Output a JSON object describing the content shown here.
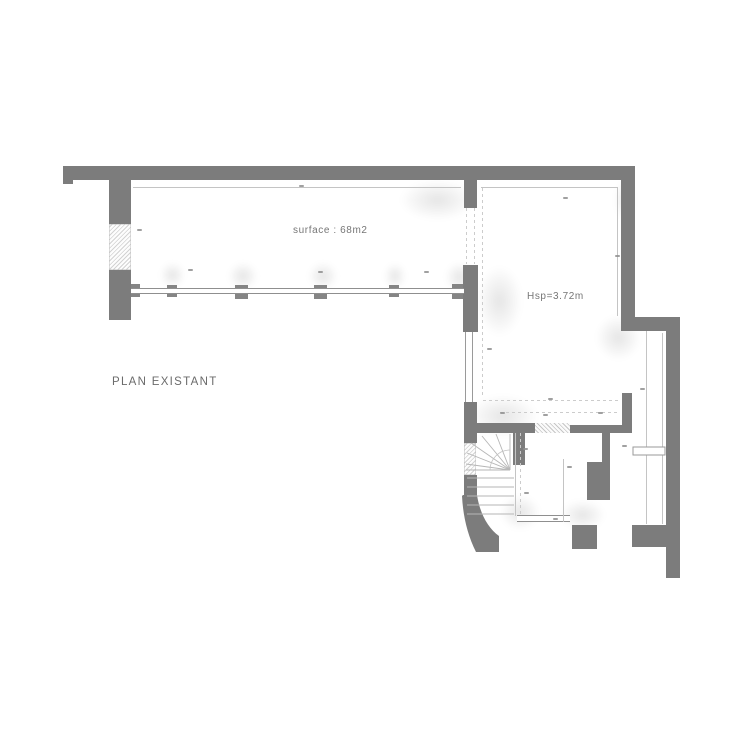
{
  "title": {
    "text": "PLAN EXISTANT",
    "x": 112,
    "y": 377
  },
  "room_labels": [
    {
      "id": "surface",
      "text": "surface : 68m2",
      "x": 293,
      "y": 226
    },
    {
      "id": "height",
      "text": "Hsp=3.72m",
      "x": 527,
      "y": 292
    }
  ],
  "colors": {
    "wall": "#7c7c7c",
    "window_fill": "#ececec",
    "window_line": "#9a9a9a",
    "thin_line": "#c4c4c4",
    "dash_line": "#cccccc",
    "tread": "#b6b6b6",
    "arc": "#c2c2c2",
    "door_stroke": "#9a9a9a",
    "text": "#767676",
    "mark": "#8f8f8f"
  },
  "plan": {
    "walls": [
      [
        63,
        166,
        572,
        14
      ],
      [
        63,
        180,
        10,
        4
      ],
      [
        109,
        180,
        22,
        44
      ],
      [
        109,
        270,
        22,
        50
      ],
      [
        464,
        180,
        13,
        28
      ],
      [
        463,
        265,
        15,
        67
      ],
      [
        621,
        180,
        14,
        137
      ],
      [
        621,
        317,
        59,
        14
      ],
      [
        666,
        331,
        14,
        247
      ],
      [
        464,
        402,
        13,
        41
      ],
      [
        464,
        475,
        13,
        22
      ],
      [
        473,
        423,
        62,
        10
      ],
      [
        513,
        433,
        12,
        32
      ],
      [
        602,
        433,
        8,
        29
      ],
      [
        587,
        462,
        23,
        38
      ],
      [
        570,
        425,
        62,
        8
      ],
      [
        622,
        393,
        10,
        32
      ],
      [
        572,
        525,
        25,
        24
      ],
      [
        632,
        525,
        34,
        22
      ]
    ],
    "piers": [
      [
        131,
        284,
        9,
        13
      ],
      [
        167,
        285,
        10,
        12
      ],
      [
        235,
        285,
        13,
        14
      ],
      [
        314,
        285,
        13,
        14
      ],
      [
        389,
        285,
        10,
        12
      ],
      [
        452,
        284,
        11,
        15
      ]
    ],
    "windows": [
      {
        "rect": [
          109,
          224,
          22,
          46
        ],
        "style": "hatch",
        "name": "window-left-wall"
      },
      {
        "rect": [
          464,
          443,
          12,
          32
        ],
        "style": "hatch",
        "name": "window-stair-wall"
      },
      {
        "rect": [
          465,
          332,
          6,
          70
        ],
        "style": "vlines",
        "name": "glazing-lower-left"
      },
      {
        "rect": [
          517,
          515,
          53,
          5
        ],
        "style": "hlines",
        "name": "glazing-bottom"
      },
      {
        "rect": [
          131,
          288,
          333,
          4
        ],
        "style": "hlines",
        "name": "window-band-long-room"
      }
    ],
    "hatches": [
      [
        535,
        423,
        35,
        10
      ]
    ],
    "lines": [
      {
        "p": [
          133,
          187,
          461,
          187
        ],
        "dashed": false
      },
      {
        "p": [
          481,
          187,
          617,
          187
        ],
        "dashed": false
      },
      {
        "p": [
          617,
          187,
          617,
          316
        ],
        "dashed": false
      },
      {
        "p": [
          482,
          188,
          482,
          398
        ],
        "dashed": true
      },
      {
        "p": [
          483,
          400,
          620,
          400
        ],
        "dashed": true
      },
      {
        "p": [
          500,
          412,
          618,
          412
        ],
        "dashed": true
      },
      {
        "p": [
          520,
          433,
          520,
          515
        ],
        "dashed": true
      },
      {
        "p": [
          563,
          459,
          563,
          522
        ],
        "dashed": false
      },
      {
        "p": [
          646,
          331,
          646,
          524
        ],
        "dashed": false
      },
      {
        "p": [
          662,
          333,
          662,
          524
        ],
        "dashed": false
      },
      {
        "p": [
          466,
          208,
          466,
          264
        ],
        "dashed": true
      },
      {
        "p": [
          474,
          208,
          474,
          264
        ],
        "dashed": true
      },
      {
        "p": [
          515,
          433,
          515,
          516
        ],
        "dashed": false
      }
    ],
    "door": [
      633,
      447,
      32,
      8
    ],
    "curve_wall": "M463,495 L477,495 C480,514 488,528 499,536 L499,552 L476,552 C467,534 463,515 462,496 Z",
    "stairs": {
      "treads": [
        [
          467,
          478,
          514,
          478
        ],
        [
          467,
          487,
          514,
          487
        ],
        [
          467,
          496,
          514,
          496
        ],
        [
          467,
          505,
          514,
          505
        ],
        [
          467,
          514,
          514,
          514
        ]
      ],
      "center": [
        510,
        470
      ],
      "rays": [
        [
          510,
          434
        ],
        [
          496,
          434
        ],
        [
          482,
          436
        ],
        [
          471,
          443
        ],
        [
          467,
          453
        ],
        [
          466,
          464
        ],
        [
          466,
          470
        ]
      ],
      "arc": "M510,450 A20,20 0 0 0 490,470"
    },
    "dim_marks": [
      [
        299,
        185
      ],
      [
        563,
        197
      ],
      [
        137,
        229
      ],
      [
        188,
        269
      ],
      [
        318,
        271
      ],
      [
        424,
        271
      ],
      [
        615,
        255
      ],
      [
        487,
        348
      ],
      [
        548,
        398
      ],
      [
        500,
        412
      ],
      [
        543,
        414
      ],
      [
        598,
        412
      ],
      [
        640,
        388
      ],
      [
        523,
        448
      ],
      [
        567,
        466
      ],
      [
        524,
        492
      ],
      [
        553,
        518
      ],
      [
        622,
        445
      ]
    ],
    "shadows": [
      [
        400,
        180,
        75,
        40
      ],
      [
        477,
        266,
        45,
        70
      ],
      [
        160,
        262,
        25,
        26
      ],
      [
        228,
        262,
        30,
        28
      ],
      [
        308,
        262,
        30,
        28
      ],
      [
        384,
        263,
        22,
        26
      ],
      [
        445,
        262,
        30,
        30
      ],
      [
        468,
        395,
        70,
        42
      ],
      [
        596,
        315,
        45,
        45
      ],
      [
        500,
        495,
        40,
        35
      ],
      [
        560,
        500,
        45,
        30
      ],
      [
        615,
        180,
        20,
        40
      ]
    ]
  }
}
